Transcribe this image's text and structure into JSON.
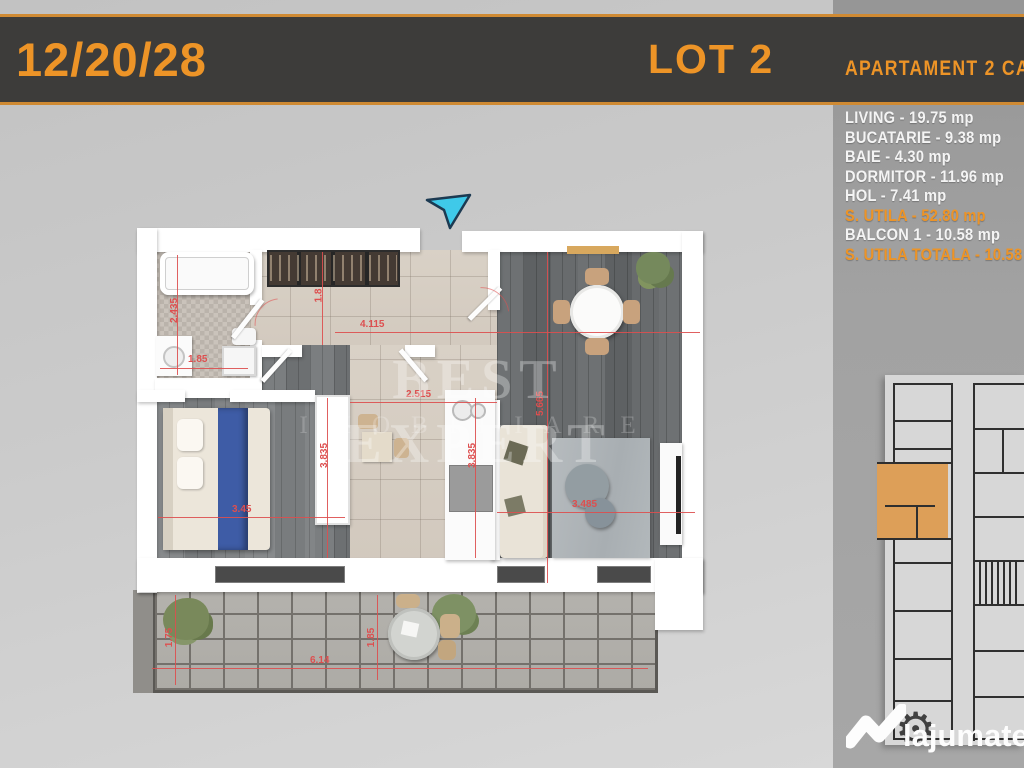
{
  "header": {
    "date": "12/20/28",
    "lot": "LOT 2",
    "subtitle": "APARTAMENT 2 CAMERE"
  },
  "rooms": [
    {
      "text": "LIVING - 19.75 mp",
      "highlight": false
    },
    {
      "text": "BUCATARIE - 9.38 mp",
      "highlight": false
    },
    {
      "text": "BAIE - 4.30 mp",
      "highlight": false
    },
    {
      "text": "DORMITOR - 11.96 mp",
      "highlight": false
    },
    {
      "text": "HOL - 7.41 mp",
      "highlight": false
    },
    {
      "text": "S. UTILA - 52.80 mp",
      "highlight": true
    },
    {
      "text": "BALCON 1 - 10.58 mp",
      "highlight": false
    },
    {
      "text": "S. UTILA TOTALA - 10.58 mp",
      "highlight": true
    }
  ],
  "floorplan": {
    "watermark": {
      "line1": "BEST EXPERT",
      "line2": "IMOBILIARE"
    },
    "dims": [
      "2.435",
      "1.85",
      "1.8",
      "4.115",
      "2.515",
      "3.45",
      "3.835",
      "3.835",
      "3.485",
      "5.665",
      "1.75",
      "1.85",
      "6.14"
    ]
  },
  "logo": {
    "brand": "lajumate",
    "tld": ".ro"
  },
  "icons": {
    "gear": "⚙",
    "entrance_arrow": "cyan-cursor-arrow",
    "house": "white-roof-check"
  },
  "colors": {
    "accent_orange": "#ED9427",
    "dimension_red": "#DD4F4F",
    "entrance_cyan": "#3FC9E9",
    "highlighted_unit_orange": "#DD9F58",
    "header_bar": "#3D3C3A"
  }
}
